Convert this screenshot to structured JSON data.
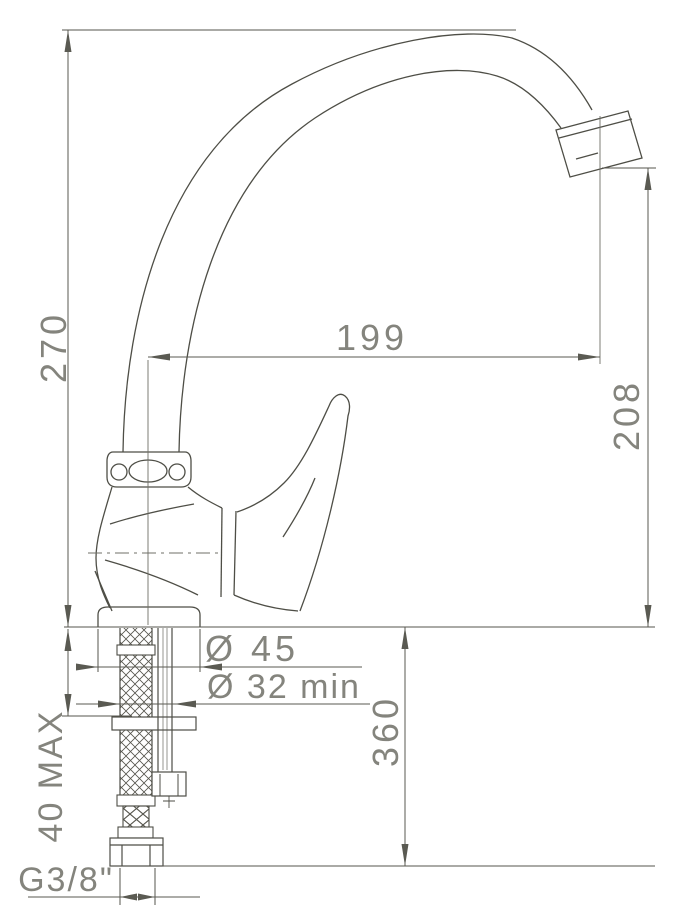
{
  "drawing": {
    "kind": "technical-dimension-drawing",
    "subject": "single-lever kitchen mixer tap, side view",
    "colors": {
      "outline": "#4e4e46",
      "dimension_line": "#5a5a52",
      "label_text": "#84847d",
      "background": "#ffffff"
    },
    "labels": {
      "overall_height": "270",
      "spout_reach": "199",
      "outlet_height": "208",
      "hose_drop": "360",
      "deck_thickness": "40 MAX",
      "base_diameter": "Ø 45",
      "hole_diameter": "Ø 32 min",
      "hose_thread": "G3/8\""
    }
  }
}
